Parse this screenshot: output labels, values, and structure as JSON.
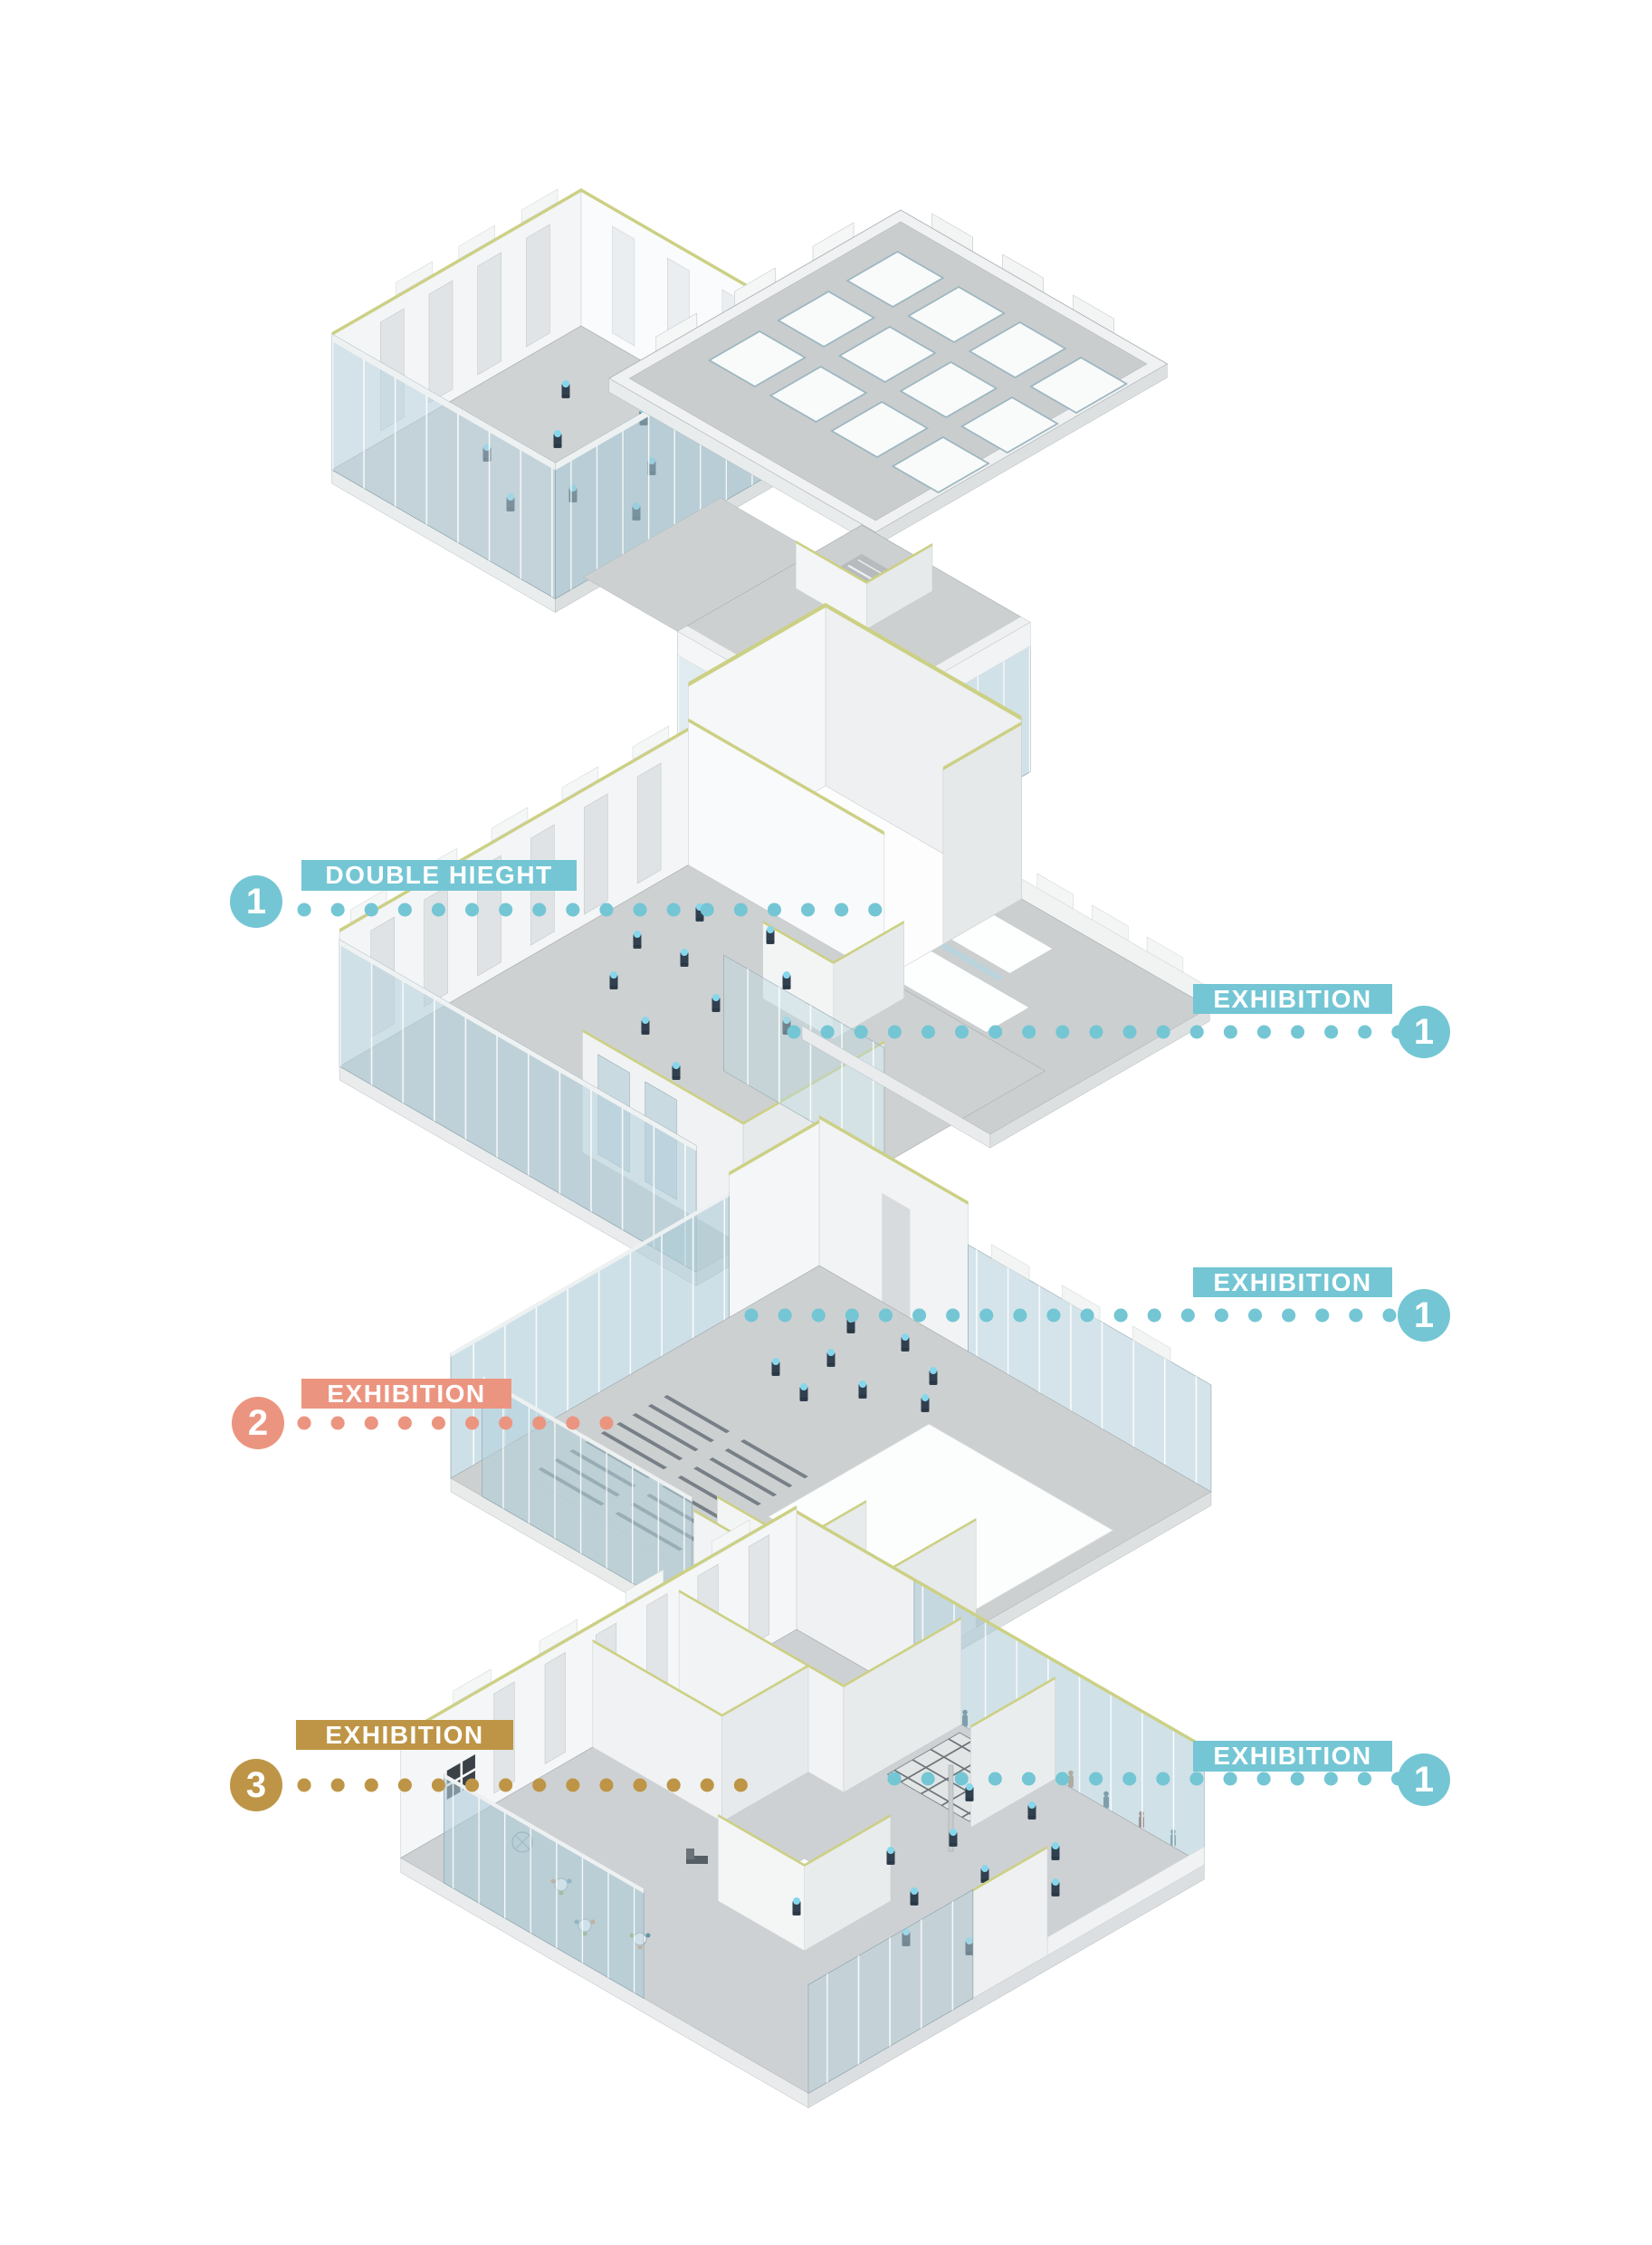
{
  "diagram": {
    "kind": "exploded-axonometric-building-diagram",
    "background": "#ffffff"
  },
  "palette": {
    "teal": "#74C6D4",
    "salmon": "#EB9580",
    "gold": "#BE9546",
    "label_text": "#FFFFFF",
    "floor_gray": "#CDD0D1",
    "wall_white": "#F3F5F6",
    "glass_blue": "#AECBD8",
    "wall_cap_green": "#CCD084"
  },
  "annotations": [
    {
      "id": "double-height",
      "number": "1",
      "label": "DOUBLE HIEGHT",
      "color": "#74C6D4",
      "side": "left"
    },
    {
      "id": "exhibition-upper-right",
      "number": "1",
      "label": "EXHIBITION",
      "color": "#74C6D4",
      "side": "right"
    },
    {
      "id": "exhibition-mid-right",
      "number": "1",
      "label": "EXHIBITION",
      "color": "#74C6D4",
      "side": "right"
    },
    {
      "id": "exhibition-mid-left",
      "number": "2",
      "label": "EXHIBITION",
      "color": "#EB9580",
      "side": "left"
    },
    {
      "id": "exhibition-lower-left",
      "number": "3",
      "label": "EXHIBITION",
      "color": "#BE9546",
      "side": "left"
    },
    {
      "id": "exhibition-lower-right",
      "number": "1",
      "label": "EXHIBITION",
      "color": "#74C6D4",
      "side": "right"
    }
  ],
  "floors": [
    {
      "id": "roof-level",
      "description": "roof plate with skylights, glass gallery room and entrance pavilion"
    },
    {
      "id": "upper-level",
      "description": "double height void, exhibition wing with roof openings, gallery room"
    },
    {
      "id": "middle-level",
      "description": "exhibition hall with auditorium seating and open void"
    },
    {
      "id": "ground-level",
      "description": "exhibition hall, services, cafe and revolving door entrance"
    }
  ]
}
